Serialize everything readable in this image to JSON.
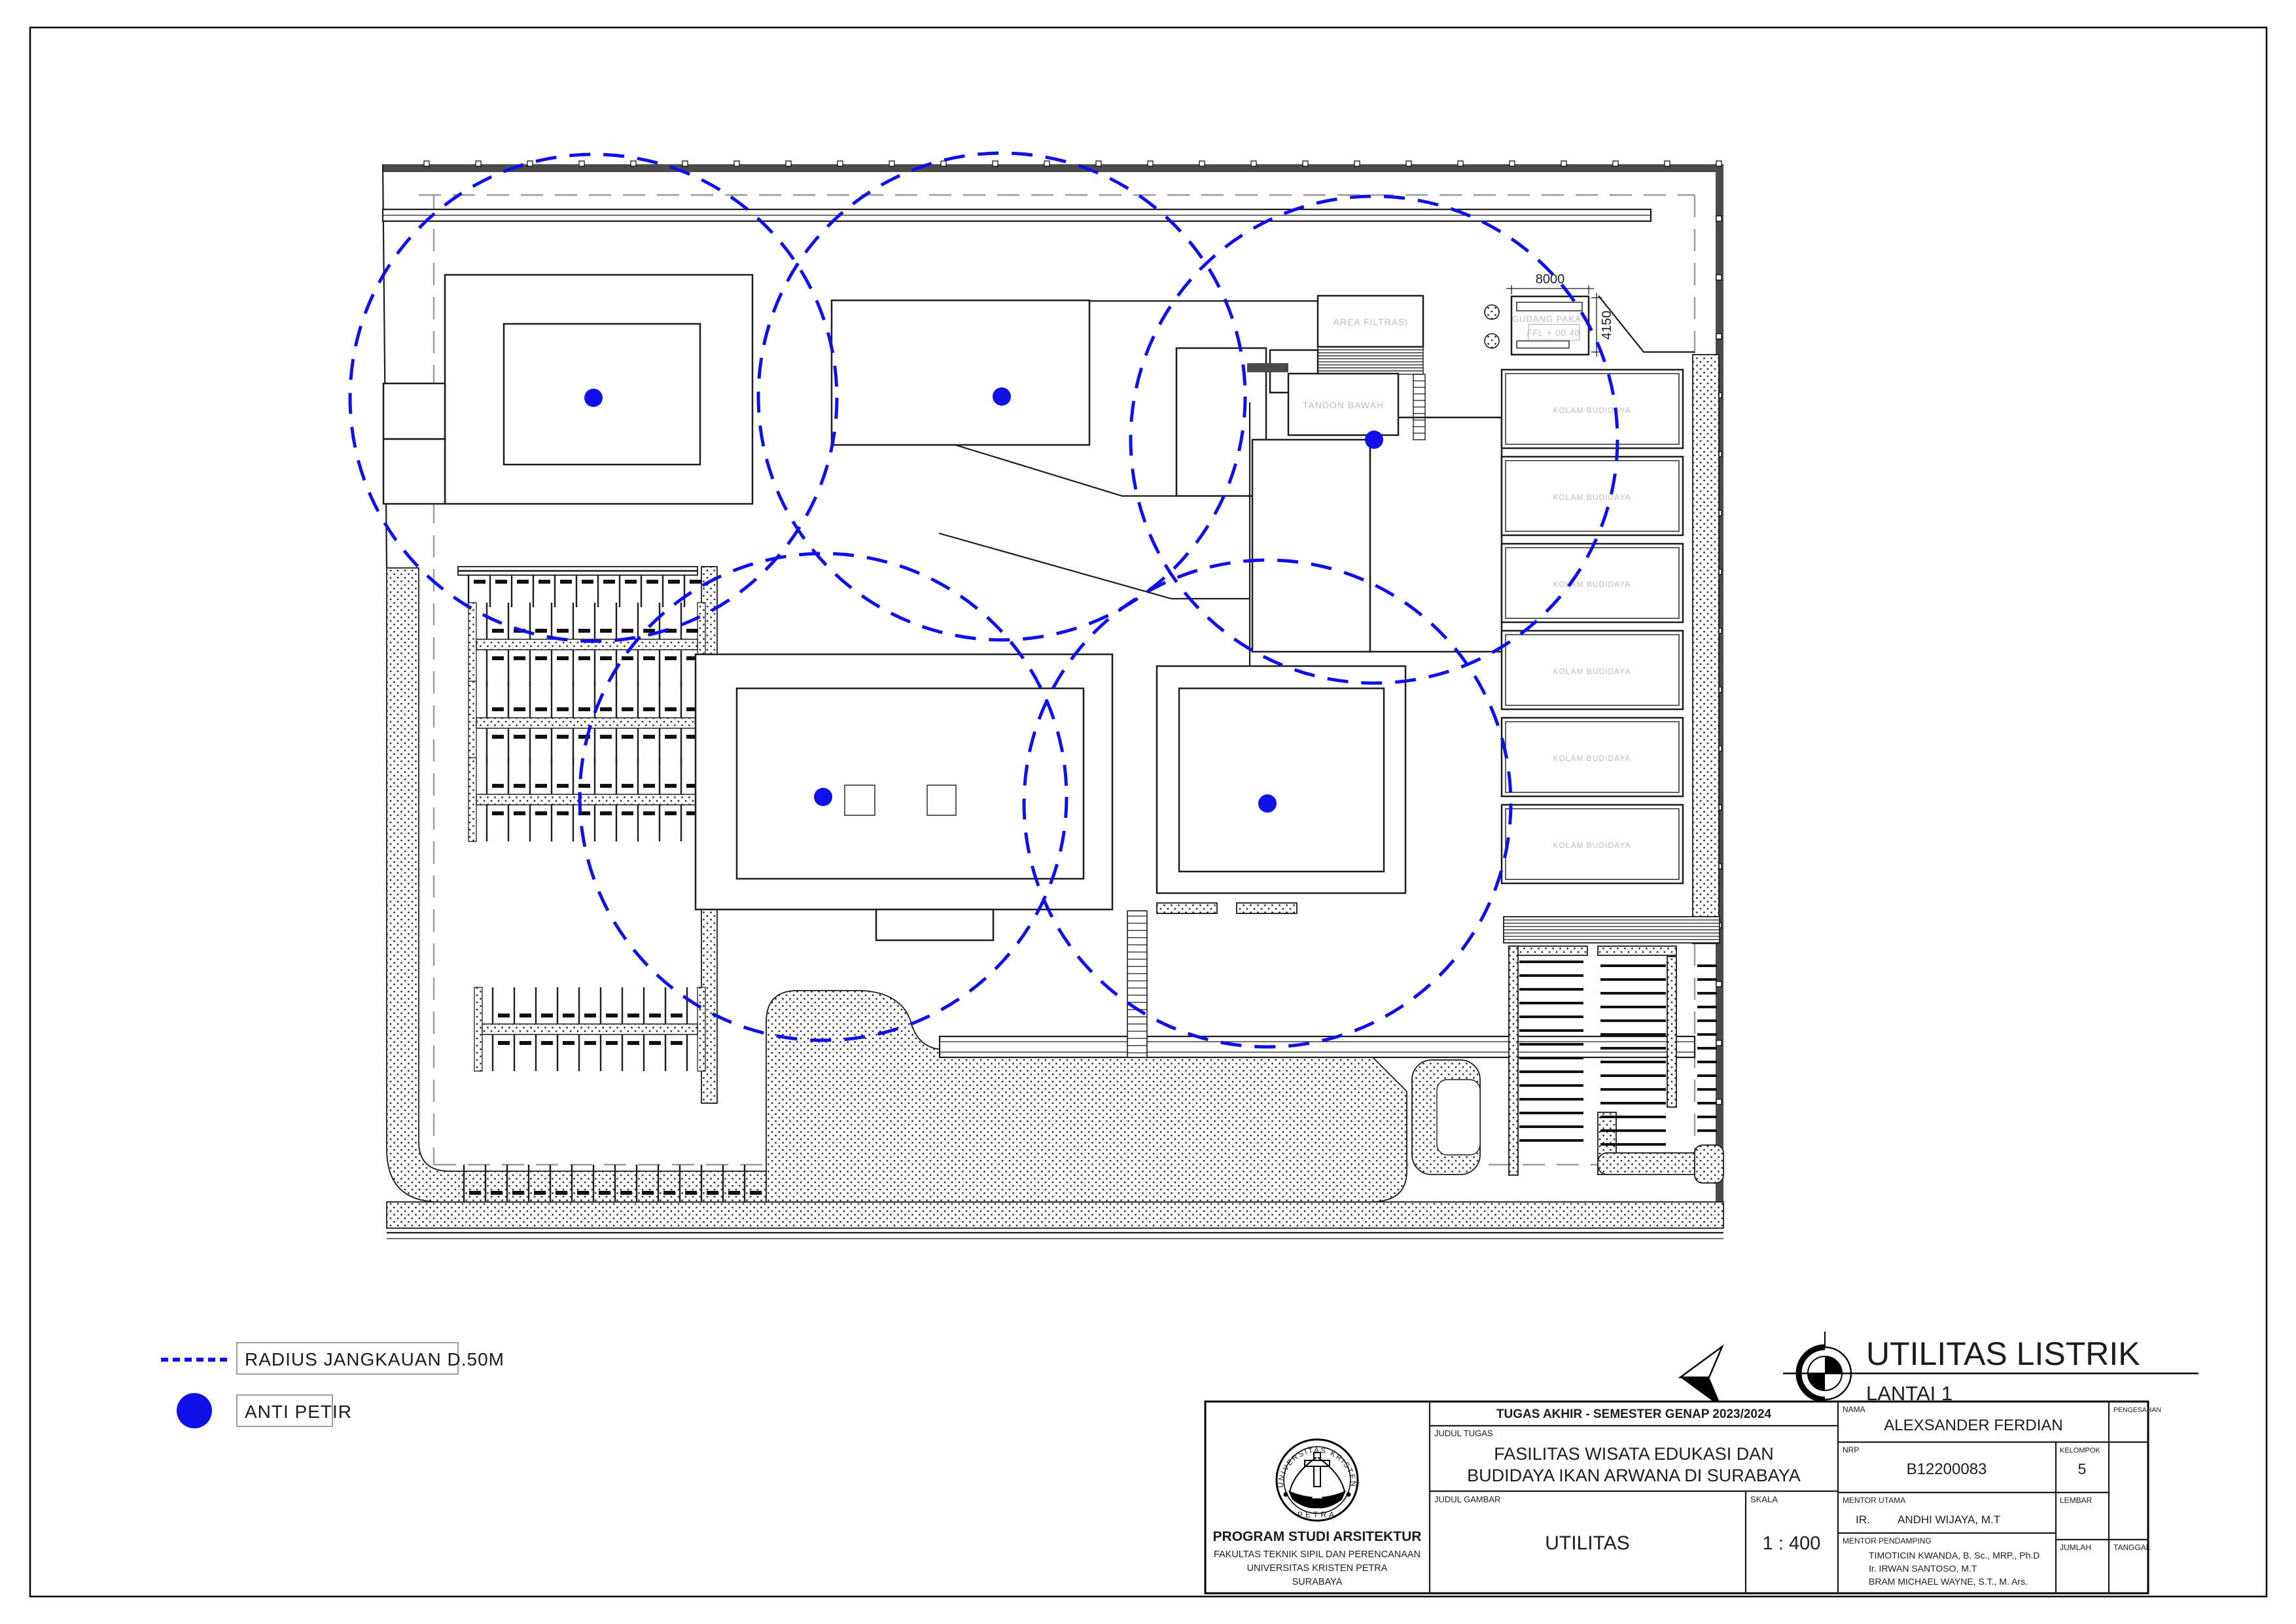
{
  "colors": {
    "blue": "#1010e8",
    "line": "#1c1c1c",
    "faint_label": "#bdbdbd",
    "dash_gray": "#9a9a9a",
    "band_dark": "#4b4b4b"
  },
  "plan": {
    "room_labels": {
      "area_filtrasi": "AREA FILTRASI",
      "tandon_bawah": "TANDON BAWAH",
      "gudang_pakan": "GUDANG PAKAN",
      "ffl": "FFL  +  00.40",
      "kolam": "KOLAM BUDIDAYA"
    },
    "dimensions": {
      "gudang_width": "8000",
      "gudang_depth": "4150"
    },
    "kolam_count": 6,
    "anti_petir_points": [
      [
        907,
        608
      ],
      [
        1531,
        606
      ],
      [
        2100,
        672
      ],
      [
        1258,
        1218
      ],
      [
        1937,
        1228
      ]
    ],
    "coverage_radius": 372
  },
  "legend": {
    "items": [
      {
        "symbol": "dashed-line",
        "label": "RADIUS JANGKAUAN D.50M"
      },
      {
        "symbol": "dot",
        "label": "ANTI PETIR"
      }
    ]
  },
  "drawing_title": {
    "main": "UTILITAS LISTRIK",
    "floor": "LANTAI 1"
  },
  "title_block": {
    "header": "TUGAS AKHIR - SEMESTER GENAP 2023/2024",
    "labels": {
      "judul_tugas": "JUDUL TUGAS",
      "judul_gambar": "JUDUL GAMBAR",
      "skala": "SKALA",
      "nama": "NAMA",
      "nrp": "NRP",
      "kelompok": "KELOMPOK",
      "mentor_utama": "MENTOR UTAMA",
      "mentor_pendamping": "MENTOR PENDAMPING",
      "lembar": "LEMBAR",
      "jumlah": "JUMLAH",
      "tanggal": "TANGGAL",
      "pengesahan": "PENGESAHAN"
    },
    "judul_tugas_line1": "FASILITAS WISATA EDUKASI DAN",
    "judul_tugas_line2": "BUDIDAYA IKAN ARWANA DI SURABAYA",
    "judul_gambar": "UTILITAS",
    "skala": "1 : 400",
    "nama": "ALEXSANDER FERDIAN",
    "nrp": "B12200083",
    "kelompok": "5",
    "mentor_utama_prefix": "IR.",
    "mentor_utama": "ANDHI WIJAYA, M.T",
    "mentor_pendamping": [
      "TIMOTICIN KWANDA, B. Sc., MRP., Ph.D",
      "Ir. IRWAN SANTOSO, M.T",
      "BRAM MICHAEL WAYNE, S.T., M. Ars."
    ],
    "institution": {
      "logo_top": "UNIVERSITAS KRISTEN",
      "logo_bottom": "PETRA",
      "line1": "PROGRAM STUDI ARSITEKTUR",
      "line2": "FAKULTAS TEKNIK SIPIL DAN PERENCANAAN",
      "line3": "UNIVERSITAS KRISTEN PETRA",
      "line4": "SURABAYA"
    }
  }
}
